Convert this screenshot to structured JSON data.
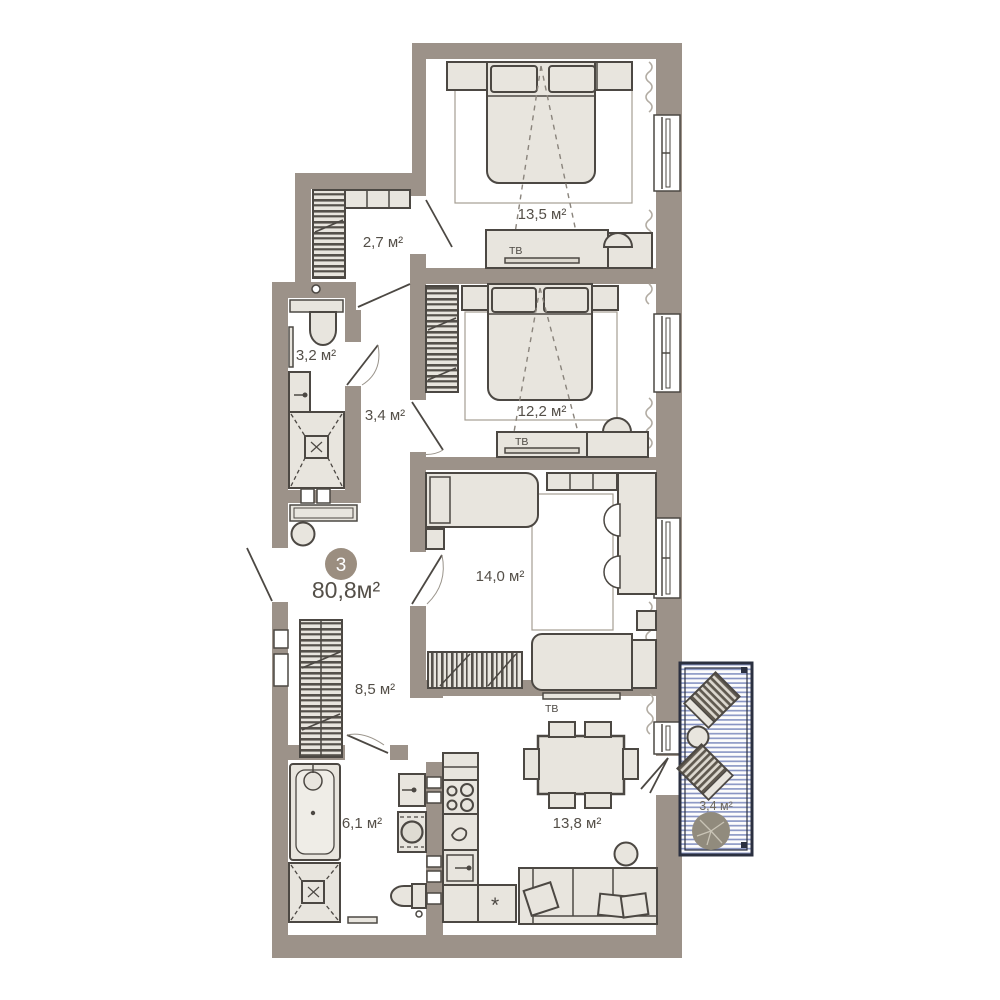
{
  "plan": {
    "apartment_number": "3",
    "total_area": "80,8м²",
    "rooms": [
      {
        "name": "hall-upper",
        "area_label": "2,7 м²"
      },
      {
        "name": "bedroom-1",
        "area_label": "13,5 м²"
      },
      {
        "name": "bathroom-upper",
        "area_label": "3,2 м²"
      },
      {
        "name": "hall-middle",
        "area_label": "3,4 м²"
      },
      {
        "name": "bedroom-2",
        "area_label": "12,2 м²"
      },
      {
        "name": "bedroom-3",
        "area_label": "14,0 м²"
      },
      {
        "name": "hall-lower",
        "area_label": "8,5 м²"
      },
      {
        "name": "bathroom-lower",
        "area_label": "6,1 м²"
      },
      {
        "name": "living-kitchen",
        "area_label": "13,8 м²"
      },
      {
        "name": "balcony",
        "area_label": "3,4 м²"
      }
    ],
    "labels": {
      "tv": "ТВ",
      "fridge": "*"
    },
    "colors": {
      "wall": "#9c9289",
      "furniture": "#e8e5de",
      "outline": "#4c4843",
      "balcony_stripe": "#8793c2",
      "balcony_border": "#2b3040",
      "badge": "#9b8e80",
      "text": "#544f48"
    }
  }
}
